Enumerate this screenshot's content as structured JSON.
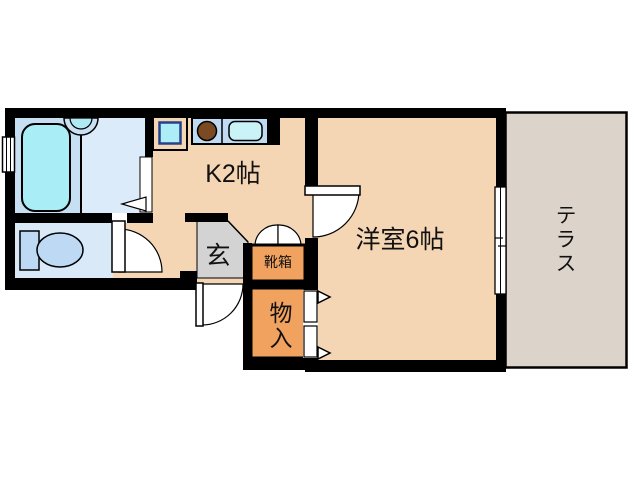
{
  "plan": {
    "type": "floor-plan",
    "rooms": {
      "kitchen": {
        "label": "K2帖"
      },
      "western_room": {
        "label": "洋室6帖"
      },
      "terrace": {
        "label": "テラス"
      },
      "entrance": {
        "label": "玄"
      },
      "shoe_box": {
        "label": "靴箱"
      },
      "storage": {
        "label": "物入"
      }
    },
    "icons": {
      "bathtub": "bathtub-icon",
      "washbasin": "washbasin-icon",
      "toilet": "toilet-icon",
      "stove": "stove-burner-icon",
      "kitchen_sink": "kitchen-sink-icon",
      "washer_pan": "washing-machine-pan-icon",
      "window": "sliding-window-icon",
      "door": "door-swing-icon"
    },
    "colors": {
      "wall": "#000000",
      "floor_tan": "#F4D6B4",
      "bath_floor": "#C7DFF3",
      "washroom_floor": "#DCEBF9",
      "toilet_floor": "#D9E9F8",
      "fixture_cyan": "#A9EDF6",
      "basin_ring": "#C9E0F4",
      "basin_inner": "#AFE9F2",
      "counter_blue": "#BFDAF3",
      "sink_cyan": "#C9F3F6",
      "stove_brown": "#7B4A23",
      "toilet_blue": "#BDD9F4",
      "washer_inner": "#ADEDF6",
      "entrance_gray": "#D3D3D3",
      "storage_orange": "#F0A25E",
      "terrace_gray": "#DCD4CA",
      "door_white": "#FFFFFF"
    }
  }
}
